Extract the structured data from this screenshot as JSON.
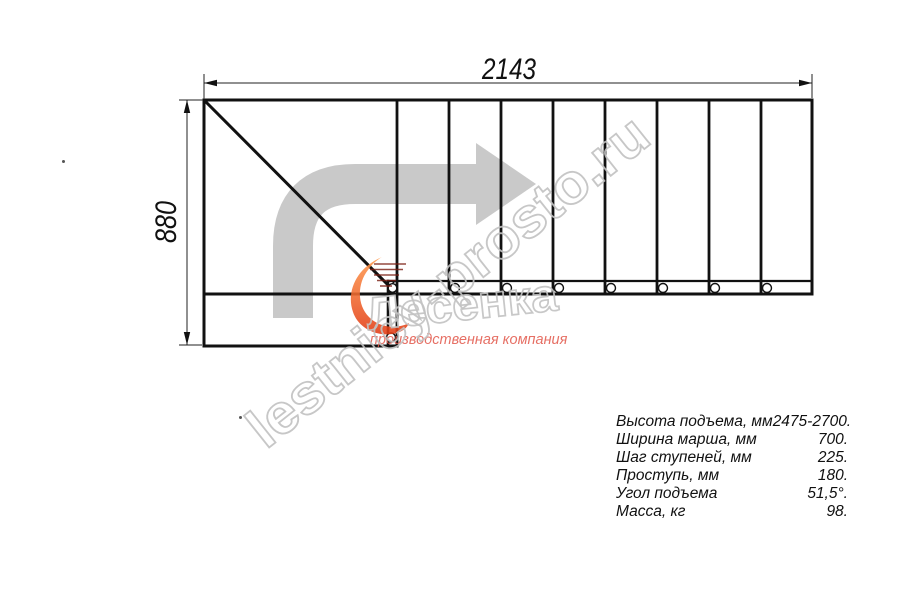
{
  "drawing": {
    "title": "stair-plan-top-view",
    "dim_width_mm": "2143",
    "dim_height_mm": "880"
  },
  "watermark": {
    "site": "lestnicy-prosto.ru",
    "logo_text": "Лесенка",
    "tagline": "производственная компания"
  },
  "specs": {
    "rows": [
      {
        "label": "Высота подъема, мм",
        "value": "2475-2700."
      },
      {
        "label": "Ширина марша, мм",
        "value": "700."
      },
      {
        "label": "Шаг ступеней, мм",
        "value": "225."
      },
      {
        "label": "Проступь, мм",
        "value": "180."
      },
      {
        "label": "Угол подъема",
        "value": "51,5°."
      },
      {
        "label": "Масса, кг",
        "value": "98."
      }
    ]
  },
  "colors": {
    "line": "#111111",
    "dimension": "#222222",
    "arrow_gray": "#c9c9c9",
    "watermark_outline": "#c2c2c2",
    "logo_orange_top": "#ff9a4d",
    "logo_orange_bottom": "#e23b14",
    "tagline_red": "#e2574a"
  }
}
